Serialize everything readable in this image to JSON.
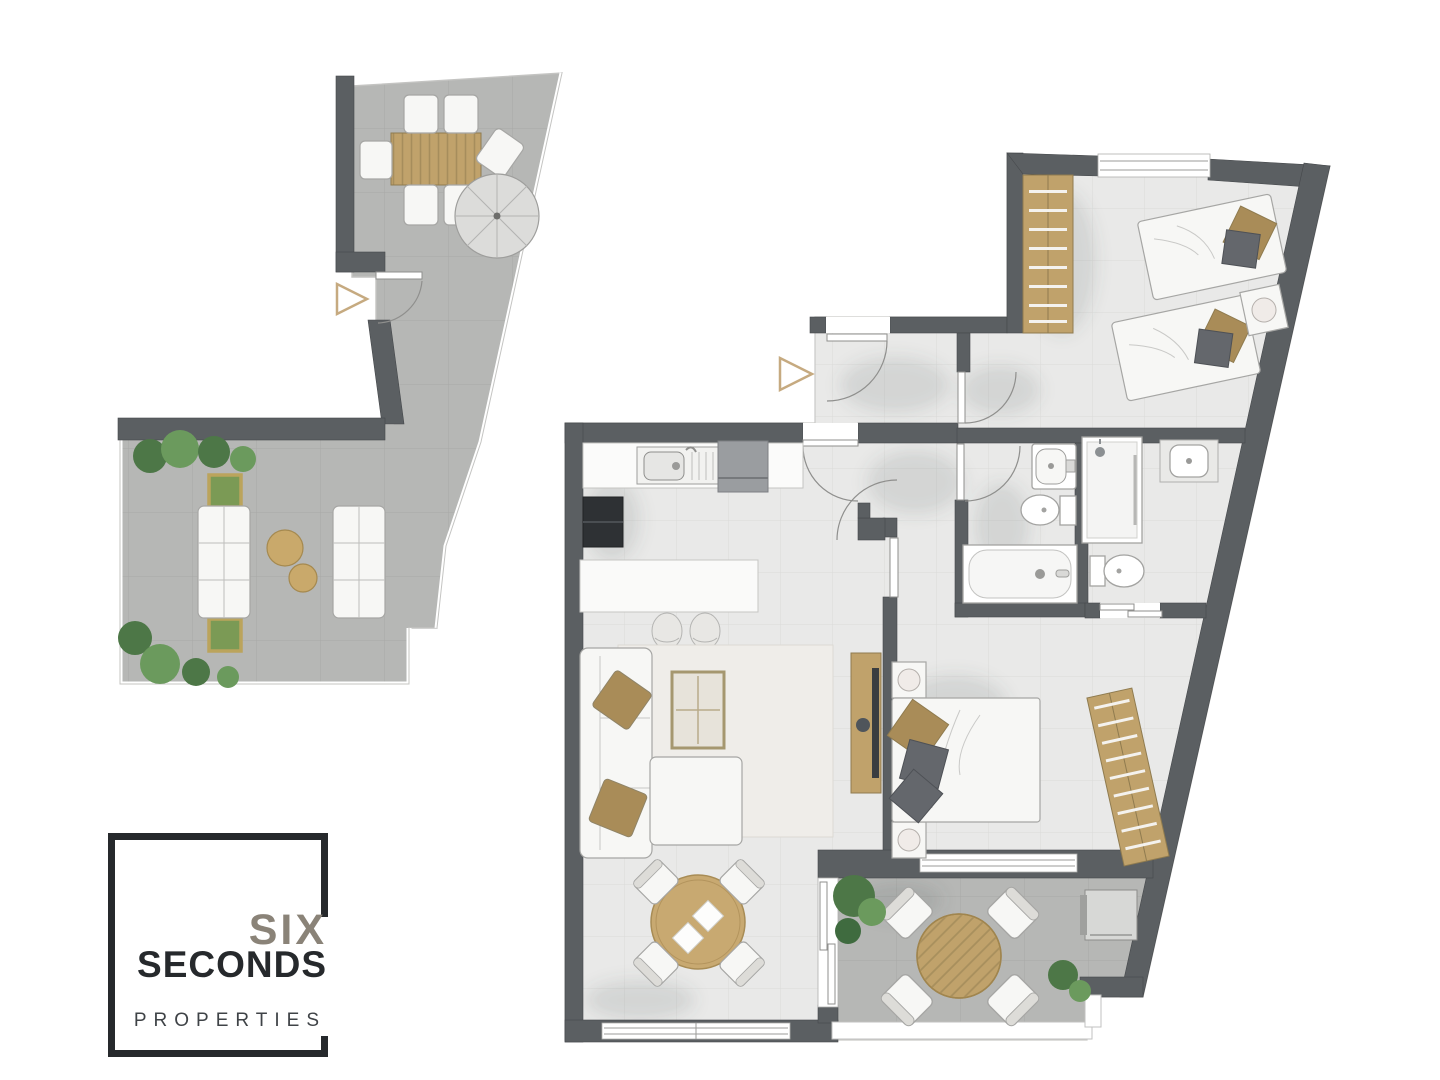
{
  "brand": {
    "line1": "SIX",
    "line2": "SECONDS",
    "line3": "PROPERTIES"
  },
  "colors": {
    "wall": "#5b5f62",
    "indoor_floor": "#e9e9e8",
    "indoor_tile_line": "#dbdbd9",
    "terrace_floor": "#b6b7b5",
    "terrace_tile_line": "#a8a9a6",
    "wood": "#c0a26b",
    "wood_dark": "#8f7b4f",
    "furniture_white": "#f7f7f5",
    "furniture_outline": "#a6a6a4",
    "pillow_tan": "#a98c58",
    "pillow_gray": "#64676c",
    "plant_green": "#4d7747",
    "plant_green_light": "#6b9a5d",
    "arrow_tan": "#c6aa80",
    "appliance_dark": "#2e3134",
    "appliance_gray": "#9a9da0",
    "umbrella": "#dcdcda",
    "rug": "#efede9",
    "logo_black": "#26292c",
    "logo_gray": "#8a8378",
    "logo_properties": "#3f4347"
  },
  "floor_plan": {
    "type": "apartment floor plan, top-down architectural rendering",
    "left_terrace_unit": {
      "areas": [
        {
          "name": "upper terrace",
          "features": [
            "outdoor dining table",
            "4 cushioned chairs",
            "parasol umbrella",
            "entrance door with swing arc",
            "entrance arrow marker"
          ]
        },
        {
          "name": "lower terrace",
          "features": [
            "2 outdoor sofas facing each other",
            "2 round coffee tables",
            "2 square planters",
            "shrubs and plants"
          ]
        }
      ]
    },
    "main_unit": {
      "rooms": [
        {
          "name": "entry hall",
          "features": [
            "entrance door with swing arc",
            "inner hall door"
          ]
        },
        {
          "name": "kitchen",
          "features": [
            "counter with sink and drainboard",
            "built-in appliance",
            "oven column",
            "island with 2 bar stools"
          ]
        },
        {
          "name": "living room",
          "features": [
            "corner sofa with chaise",
            "2 tan cushions",
            "area rug",
            "coffee table",
            "TV sideboard"
          ]
        },
        {
          "name": "dining area",
          "features": [
            "round wooden table",
            "4 chairs",
            "2 placemats",
            "window",
            "sliding door to terrace"
          ]
        },
        {
          "name": "twin bedroom",
          "features": [
            "2 single beds",
            "nightstand with lamp",
            "wardrobe",
            "window"
          ]
        },
        {
          "name": "bathroom",
          "features": [
            "washbasin",
            "toilet",
            "bathtub"
          ]
        },
        {
          "name": "en-suite bathroom",
          "features": [
            "shower",
            "washbasin on counter",
            "toilet",
            "sliding door"
          ]
        },
        {
          "name": "master bedroom",
          "features": [
            "double bed",
            "2 nightstands with lamps",
            "slanted wardrobe",
            "window"
          ]
        },
        {
          "name": "lower terrace",
          "features": [
            "round slatted table",
            "4 chairs",
            "air-conditioning unit",
            "plants",
            "railing"
          ]
        }
      ]
    },
    "symbols": [
      "entrance-arrow-left-unit",
      "entrance-arrow-main-unit"
    ]
  }
}
